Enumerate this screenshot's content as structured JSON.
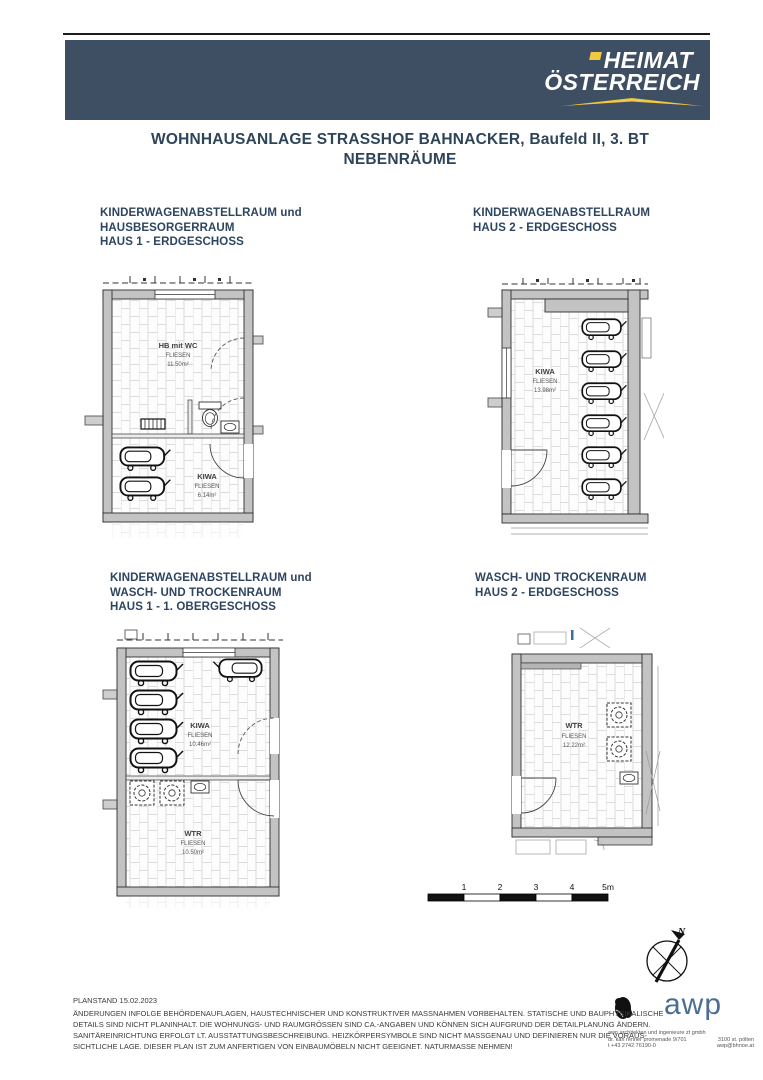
{
  "brand": {
    "line1": "HEIMAT",
    "line2": "ÖSTERREICH"
  },
  "page": {
    "title_line1": "WOHNHAUSANLAGE STRASSHOF BAHNACKER, Baufeld II, 3. BT",
    "title_line2": "NEBENRÄUME"
  },
  "sections": [
    {
      "title_lines": [
        "KINDERWAGENABSTELLRAUM und",
        "HAUSBESORGERRAUM",
        "HAUS 1 - ERDGESCHOSS"
      ]
    },
    {
      "title_lines": [
        "KINDERWAGENABSTELLRAUM",
        "HAUS 2 - ERDGESCHOSS"
      ]
    },
    {
      "title_lines": [
        "KINDERWAGENABSTELLRAUM und",
        "WASCH- UND TROCKENRAUM",
        "HAUS 1 - 1. OBERGESCHOSS"
      ]
    },
    {
      "title_lines": [
        "WASCH- UND TROCKENRAUM",
        "HAUS 2 - ERDGESCHOSS"
      ]
    }
  ],
  "rooms": {
    "plan1_room1": {
      "name": "HB mit WC",
      "finish": "FLIESEN",
      "area": "11.50m²"
    },
    "plan1_room2": {
      "name": "KIWA",
      "finish": "FLIESEN",
      "area": "6.14m²"
    },
    "plan2_room1": {
      "name": "KIWA",
      "finish": "FLIESEN",
      "area": "13.98m²"
    },
    "plan3_room1": {
      "name": "KIWA",
      "finish": "FLIESEN",
      "area": "10.46m²"
    },
    "plan3_room2": {
      "name": "WTR",
      "finish": "FLIESEN",
      "area": "10.50m²"
    },
    "plan4_room1": {
      "name": "WTR",
      "finish": "FLIESEN",
      "area": "12.22m²"
    }
  },
  "scale_bar": {
    "labels": [
      "1",
      "2",
      "3",
      "4",
      "5m"
    ]
  },
  "compass": {
    "label": "N"
  },
  "footer": {
    "planstand": "PLANSTAND 15.02.2023",
    "disclaimer_lines": [
      "ÄNDERUNGEN INFOLGE BEHÖRDENAUFLAGEN, HAUSTECHNISCHER UND KONSTRUKTIVER MASSNAHMEN VORBEHALTEN. STATISCHE UND BAUPHYSIKALISCHE",
      "DETAILS SIND NICHT PLANINHALT. DIE WOHNUNGS- UND RAUMGRÖSSEN SIND CA.-ANGABEN UND KÖNNEN SICH AUFGRUND DER DETAILPLANUNG ÄNDERN.",
      "SANITÄREINRICHTUNG ERFOLGT LT. AUSSTATTUNGSBESCHREIBUNG. HEIZKÖRPERSYMBOLE SIND NICHT MASSGENAU UND DEFINIEREN NUR DIE VORAUS-",
      "SICHTLICHE LAGE. DIESER PLAN IST ZUM ANFERTIGEN VON EINBAUMÖBELN NICHT GEEIGNET. NATURMASSE NEHMEN!"
    ]
  },
  "awp": {
    "logo": "awp",
    "address_line1": "awp architekten und ingenieure zt gmbh",
    "address_line2a": "dr. karl renner promenade 9/701",
    "address_line2b": "3100 st. pölten",
    "address_line3a": "t +43 2742 76190-0",
    "address_line3b": "awp@bhnoe.at"
  },
  "colors": {
    "header_band": "#3e4e63",
    "brand_yellow": "#f2c840",
    "heading_navy": "#2e4560",
    "awp_blue": "#4a6d94",
    "wall_gray": "#c3c3c3"
  }
}
